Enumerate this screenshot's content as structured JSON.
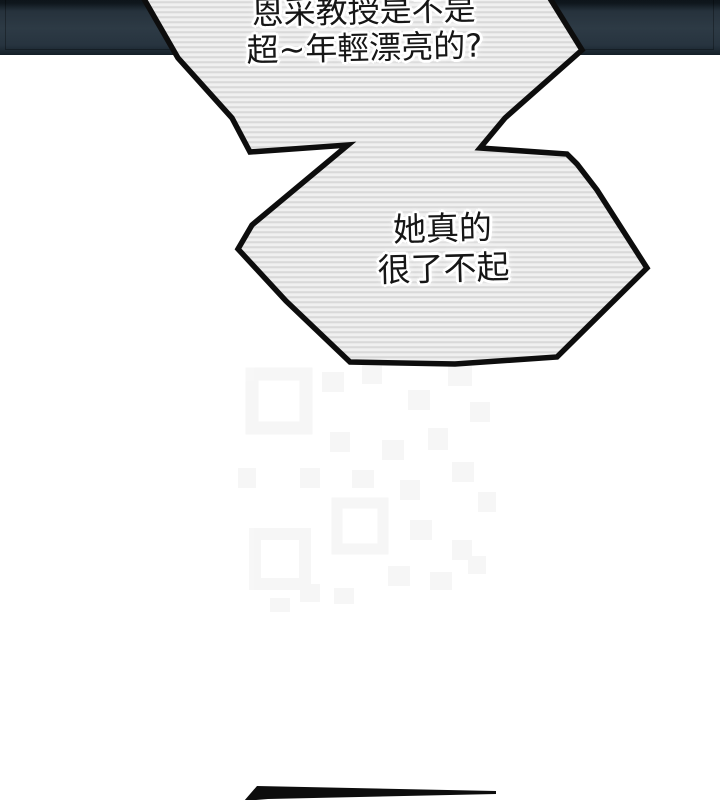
{
  "page": {
    "type": "webtoon-comic-panel",
    "background_color": "#ffffff"
  },
  "top_panel": {
    "color_main": "#2d3a45",
    "color_edge": "#0d141a"
  },
  "bubbles": [
    {
      "id": "speech-bubble-1",
      "lines": [
        "恩采教授是不是",
        "超~年輕漂亮的?"
      ]
    },
    {
      "id": "speech-bubble-2",
      "lines": [
        "她真的",
        "很了不起"
      ]
    }
  ],
  "bubble_style": {
    "fill_stripe_light": "#f0f0f0",
    "fill_stripe_dark": "#d9d9d9",
    "outline_color": "#0d0d0d",
    "text_color": "#161616",
    "halo_color": "#ffffff"
  },
  "watermark": {
    "name": "faint-qr-pattern",
    "color": "#666666"
  },
  "bottom_edge": {
    "name": "next-bubble-edge-tip",
    "color": "#0d0d0d"
  }
}
